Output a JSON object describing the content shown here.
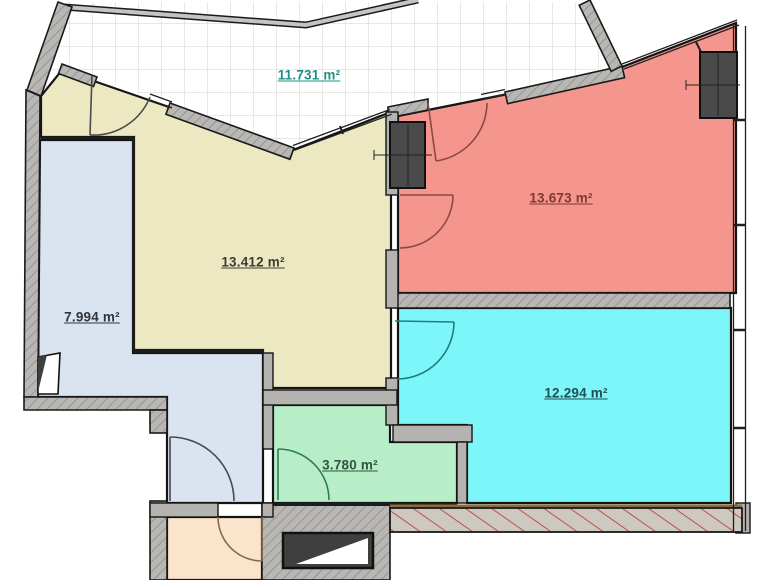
{
  "plan": {
    "kind": "apartment-floor-plan",
    "labels": {
      "terrace": {
        "text": "11.731 m²",
        "color": "#1e9087"
      },
      "room_red": {
        "text": "13.673 m²",
        "color": "#7c3a34"
      },
      "room_yellow": {
        "text": "13.412 m²",
        "color": "#3b3b33"
      },
      "hall": {
        "text": "7.994 m²",
        "color": "#33343a"
      },
      "room_cyan": {
        "text": "12.294 m²",
        "color": "#1d4f55"
      },
      "bath": {
        "text": "3.780 m²",
        "color": "#2f5540"
      }
    },
    "colors": {
      "room_yellow": "#ece9c2",
      "room_red": "#f5968e",
      "room_cyan": "#7df6f9",
      "room_green": "#b7eec8",
      "room_corridor": "#d9e4f0",
      "room_peach": "#fae4cc",
      "wall_gray": "#b5b3b0",
      "wall_dark": "#141414",
      "shaft_dark": "#4a4a4a",
      "door_gray": "#4a4a4a",
      "door_red": "#8a4a42",
      "door_teal": "#1f7d7d",
      "door_green": "#2f7d54",
      "door_brown": "#8a6a4a",
      "hatch_red": "#c0504d",
      "sill_brown": "#8a6d3b"
    }
  }
}
